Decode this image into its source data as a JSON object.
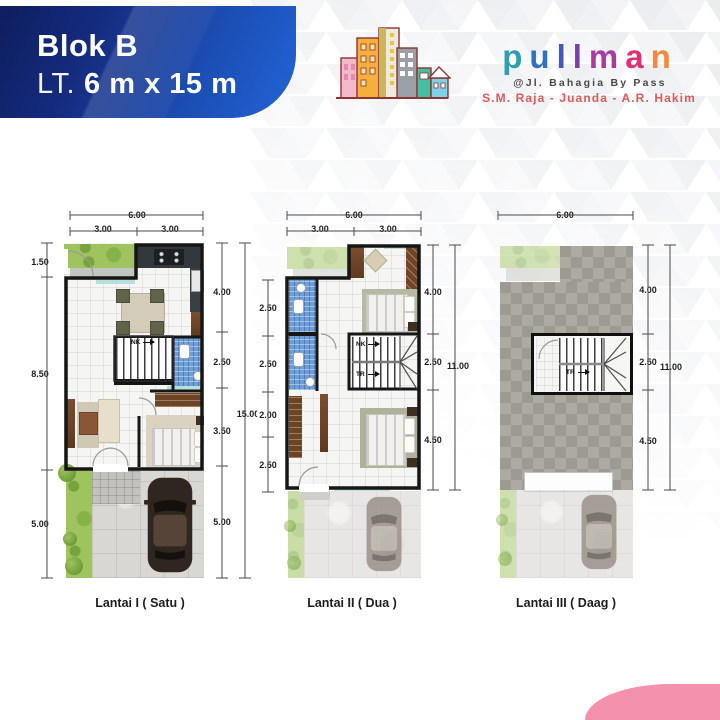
{
  "header": {
    "blok": "Blok B",
    "lt_prefix": "LT.",
    "size": "6 m x 15 m"
  },
  "logo": {
    "letters": [
      {
        "ch": "p",
        "color": "#2E9FB0"
      },
      {
        "ch": "u",
        "color": "#3172C0"
      },
      {
        "ch": "l",
        "color": "#4856B4"
      },
      {
        "ch": "l",
        "color": "#7A3FA8"
      },
      {
        "ch": "m",
        "color": "#A93BA0"
      },
      {
        "ch": "a",
        "color": "#E03177"
      },
      {
        "ch": "n",
        "color": "#F28A3D"
      }
    ],
    "address": "@Jl. Bahagia By Pass",
    "roads": "S.M. Raja - Juanda - A.R. Hakim"
  },
  "plans": [
    {
      "label": "Lantai I ( Satu )",
      "dim_top_total": "6.00",
      "dim_top_left": "3.00",
      "dim_top_right": "3.00",
      "dims_left": [
        "1.50",
        "8.50",
        "5.00"
      ],
      "dims_right": [
        "4.00",
        "2.50",
        "3.50",
        "5.00"
      ],
      "dim_right_total": "15.00",
      "stair_up": "NK"
    },
    {
      "label": "Lantai II ( Dua )",
      "dim_top_total": "6.00",
      "dim_top_left": "3.00",
      "dim_top_right": "3.00",
      "dims_left": [
        "2.50",
        "2.50",
        "2.00",
        "2.50"
      ],
      "dims_right": [
        "4.00",
        "2.50",
        "4.50"
      ],
      "dim_right_total": "11.00",
      "stair_up": "NK",
      "stair_down": "TR"
    },
    {
      "label": "Lantai III ( Daag )",
      "dim_top_total": "6.00",
      "dims_right": [
        "4.00",
        "2.50",
        "4.50"
      ],
      "dim_right_total": "11.00",
      "stair_down": "TR"
    }
  ],
  "colors": {
    "banner_dark": "#0e1e5e",
    "banner_light": "#2264d8",
    "accent_pink": "#f492ad",
    "roads_red": "#d85b5b"
  }
}
